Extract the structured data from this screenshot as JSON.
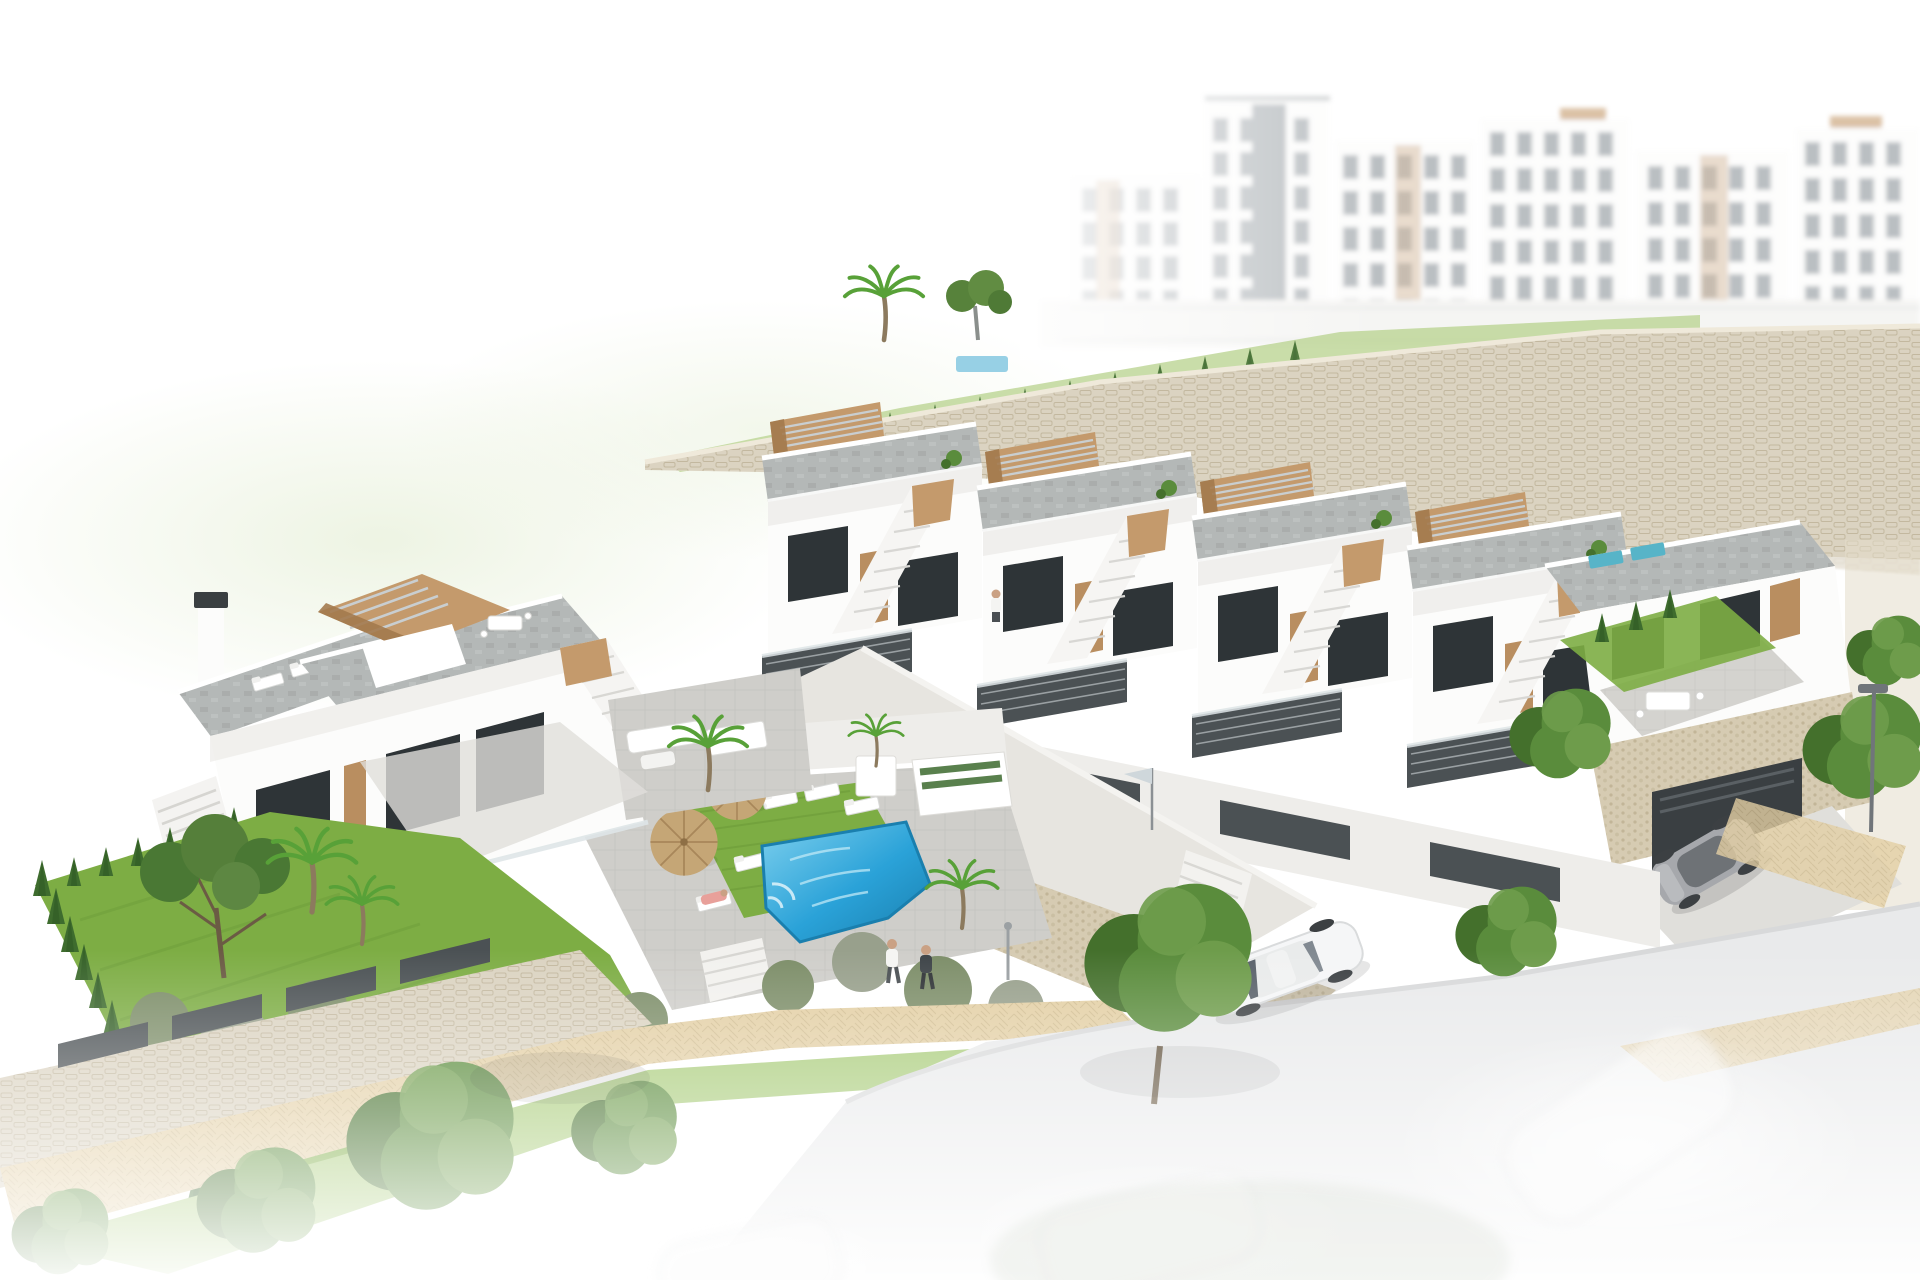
{
  "scene": {
    "medium": "3d-architectural-render",
    "view": "aerial-three-quarter",
    "background_style": "white studio fade at image edges",
    "areas": {
      "background_apartments": {
        "towers": 6,
        "style": "hazy white apartment blocks with balconies and beige panels"
      },
      "retaining_walls": "beige stone masonry terracing the hillside",
      "townhouse_row": {
        "visible_units": 4,
        "features": [
          "grey tiled roof terraces",
          "timber pergolas",
          "external staircases",
          "dark slat railings",
          "large dark glazing",
          "timber doors"
        ]
      },
      "left_villa_block": {
        "features": [
          "roof terrace with pergola",
          "white chimney",
          "terrace lounge and dining furniture",
          "stair to pool court"
        ]
      },
      "pool_courtyard": {
        "straw_umbrellas": 2,
        "sun_loungers": 6,
        "pool_shape": "rectangular",
        "lawn": true,
        "planters": 2
      },
      "upper_garden": {
        "hedges": true,
        "palm_trees": 1,
        "pine_trees": 1,
        "lap_pool_glimpse": true
      },
      "background_pool_terrace": {
        "pool": 1,
        "umbrella": 1
      },
      "left_garden": {
        "lawn": true,
        "cypress_hedge_row": true,
        "pine_tree": 1,
        "palm_trees": 2,
        "shrubs": "many"
      },
      "street_scene": {
        "white_sedan": 1,
        "grey_sports_car": 1,
        "ghost_cars": 3,
        "street_lamp": 1,
        "sandy_walkway": true,
        "flag": 1
      },
      "people": {
        "walkers_on_path": 2,
        "person_on_stairs": 1,
        "person_on_balcony": 1,
        "sunbather": 1
      },
      "garage": {
        "entrances": 1,
        "driveway": "concrete apron to street"
      }
    }
  },
  "palette": {
    "facade": "#fcfcfb",
    "facadeShade": "#eeedea",
    "wood": "#c49a6c",
    "woodDark": "#a37a4e",
    "slatTop": "#c9ced0",
    "windowDark": "#2e3437",
    "windowMid": "#8d959b",
    "door": "#b98e60",
    "slatFence": "#4b5154",
    "roofTile": "#b4b8b7",
    "roofDark": "#9da1a0",
    "stoneWall": "#dbd3c1",
    "stoneJoint": "#c3b89f",
    "pebble": "#d6cbb2",
    "ramp": "#e7e5e0",
    "grass": "#7dad44",
    "grassLight": "#a9cc7a",
    "cypress": "#3e6c2e",
    "tree": "#5a8c3c",
    "treeDark": "#44702c",
    "bush": "#7d8e69",
    "bushGrey": "#98a08c",
    "palm": "#58a138",
    "pathTan": "#e3cfa4",
    "pathShade": "#cdb98c",
    "paving": "#cfceca",
    "pavingLight": "#e0dfdb",
    "pool": "#2aa2d8",
    "poolLight": "#7ed0ee",
    "poolDark": "#1a7fae",
    "road": "#e9eaeb",
    "curb": "#d8d9da",
    "carWhite": "#f5f6f7",
    "carGrey": "#a6a8ac",
    "straw": "#c5a676",
    "haze": "#e9f1dc",
    "teal": "#57b4c8",
    "skin": "#caa184",
    "orange": "#d7804e",
    "pink": "#e8a09a",
    "lampGrey": "#70757a",
    "white": "#ffffff"
  }
}
